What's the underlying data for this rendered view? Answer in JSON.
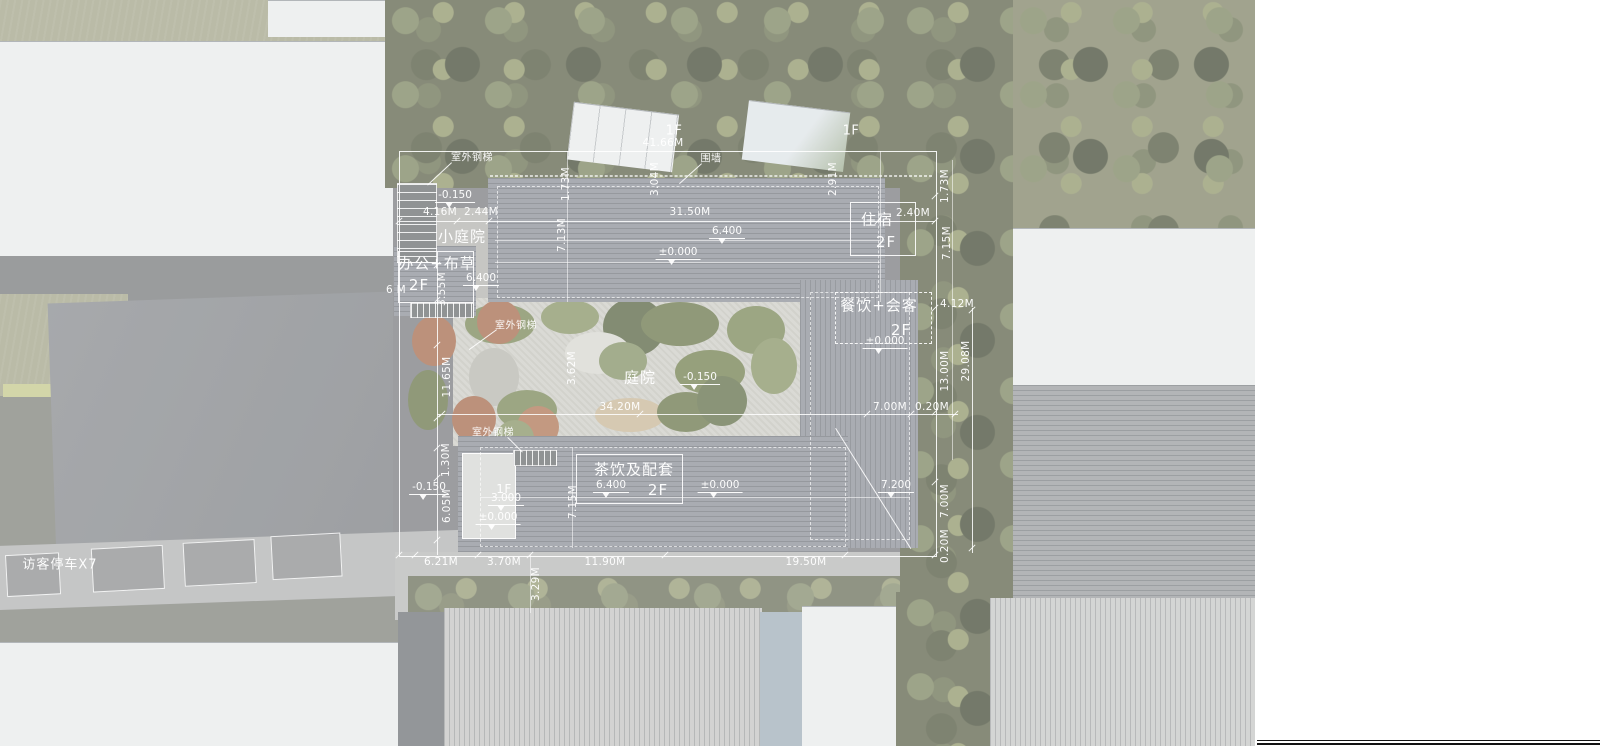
{
  "plan": {
    "room_labels": [
      {
        "t": "小庭院",
        "x": 462,
        "y": 236,
        "n": "label-small-courtyard"
      },
      {
        "t": "办公+布草",
        "x": 437,
        "y": 263,
        "n": "label-office-linen"
      },
      {
        "t": "2F",
        "x": 419,
        "y": 285,
        "n": "label-office-linen-floor"
      },
      {
        "t": "住宿",
        "x": 877,
        "y": 219,
        "n": "label-lodging"
      },
      {
        "t": "2F",
        "x": 886,
        "y": 242,
        "n": "label-lodging-floor"
      },
      {
        "t": "餐饮+会客",
        "x": 879,
        "y": 305,
        "n": "label-dining-reception"
      },
      {
        "t": "2F",
        "x": 901,
        "y": 330,
        "n": "label-dining-reception-floor"
      },
      {
        "t": "庭院",
        "x": 640,
        "y": 377,
        "n": "label-courtyard"
      },
      {
        "t": "茶饮及配套",
        "x": 634,
        "y": 469,
        "n": "label-tea-amenities"
      },
      {
        "t": "2F",
        "x": 658,
        "y": 490,
        "n": "label-tea-amenities-floor"
      },
      {
        "t": "访客停车X7",
        "x": 60,
        "y": 563,
        "s": 13,
        "n": "label-visitor-parking-x7"
      }
    ],
    "feature_labels": [
      {
        "t": "室外钢梯",
        "x": 472,
        "y": 156,
        "n": "label-outdoor-steel-stair-1"
      },
      {
        "t": "围墙",
        "x": 711,
        "y": 157,
        "n": "label-enclosure-wall"
      },
      {
        "t": "室外钢梯",
        "x": 516,
        "y": 324,
        "n": "label-outdoor-steel-stair-2"
      },
      {
        "t": "室外钢梯",
        "x": 493,
        "y": 431,
        "n": "label-outdoor-steel-stair-3"
      },
      {
        "t": "1F",
        "x": 674,
        "y": 131,
        "s": 13,
        "n": "label-outbuilding-1f-west"
      },
      {
        "t": "1F",
        "x": 851,
        "y": 131,
        "s": 13,
        "n": "label-outbuilding-1f-east"
      },
      {
        "t": "1F",
        "x": 504,
        "y": 489,
        "s": 12,
        "n": "label-entry-block-1f"
      }
    ],
    "dimensions_h": [
      {
        "t": "4.16M",
        "x": 440,
        "y": 212
      },
      {
        "t": "2.44M",
        "x": 481,
        "y": 212
      },
      {
        "t": "31.50M",
        "x": 690,
        "y": 212
      },
      {
        "t": "2.40M",
        "x": 913,
        "y": 213
      },
      {
        "t": "41.66M",
        "x": 663,
        "y": 143
      },
      {
        "t": "4.12M",
        "x": 957,
        "y": 304
      },
      {
        "t": "7.00M",
        "x": 890,
        "y": 407
      },
      {
        "t": "0.20M",
        "x": 932,
        "y": 407
      },
      {
        "t": "34.20M",
        "x": 620,
        "y": 407
      },
      {
        "t": "6.21M",
        "x": 441,
        "y": 562
      },
      {
        "t": "3.70M",
        "x": 504,
        "y": 562
      },
      {
        "t": "11.90M",
        "x": 605,
        "y": 562
      },
      {
        "t": "19.50M",
        "x": 806,
        "y": 562
      },
      {
        "t": "6 M",
        "x": 396,
        "y": 290
      }
    ],
    "dimensions_v": [
      {
        "t": "1.73M",
        "x": 566,
        "y": 184
      },
      {
        "t": "3.04M",
        "x": 655,
        "y": 179
      },
      {
        "t": "2.91M",
        "x": 833,
        "y": 179
      },
      {
        "t": "1.73M",
        "x": 945,
        "y": 186
      },
      {
        "t": "7.15M",
        "x": 947,
        "y": 243
      },
      {
        "t": "7.13M",
        "x": 562,
        "y": 235
      },
      {
        "t": "3.55M",
        "x": 442,
        "y": 289
      },
      {
        "t": "13.00M",
        "x": 945,
        "y": 371
      },
      {
        "t": "29.08M",
        "x": 966,
        "y": 361
      },
      {
        "t": "3.62M",
        "x": 572,
        "y": 368
      },
      {
        "t": "11.65M",
        "x": 447,
        "y": 377
      },
      {
        "t": "1.30M",
        "x": 446,
        "y": 460
      },
      {
        "t": "6.05M",
        "x": 447,
        "y": 506
      },
      {
        "t": "7.15M",
        "x": 573,
        "y": 502
      },
      {
        "t": "7.00M",
        "x": 945,
        "y": 501
      },
      {
        "t": "0.20M",
        "x": 945,
        "y": 546
      },
      {
        "t": "3.29M",
        "x": 536,
        "y": 584
      }
    ],
    "elevations": [
      {
        "t": "-0.150",
        "x": 455,
        "y": 196
      },
      {
        "t": "6.400",
        "x": 481,
        "y": 279
      },
      {
        "t": "6.400",
        "x": 727,
        "y": 232
      },
      {
        "t": "±0.000",
        "x": 678,
        "y": 253
      },
      {
        "t": "±0.000",
        "x": 885,
        "y": 342
      },
      {
        "t": "-0.150",
        "x": 700,
        "y": 378
      },
      {
        "t": "6.400",
        "x": 611,
        "y": 486
      },
      {
        "t": "±0.000",
        "x": 720,
        "y": 486
      },
      {
        "t": "7.200",
        "x": 896,
        "y": 486
      },
      {
        "t": "3.000",
        "x": 506,
        "y": 499
      },
      {
        "t": "±0.000",
        "x": 498,
        "y": 518
      },
      {
        "t": "-0.150",
        "x": 429,
        "y": 488
      }
    ],
    "parking": {
      "spaces": [
        {
          "x": 6,
          "y": 6,
          "w": 52,
          "h": 40
        },
        {
          "x": 92,
          "y": 4,
          "w": 70,
          "h": 42
        },
        {
          "x": 184,
          "y": 3,
          "w": 70,
          "h": 42
        },
        {
          "x": 272,
          "y": 1,
          "w": 68,
          "h": 42
        }
      ]
    }
  },
  "colors": {
    "annotation_white": "#ffffff",
    "main_roof_gray": "#8f939a",
    "white_roof": "#e9ebec",
    "tree_green": "#62674f",
    "grass": "#a5a68c",
    "gravel_court": "#cfcfc8",
    "road_gray": "#b3b4b5"
  }
}
